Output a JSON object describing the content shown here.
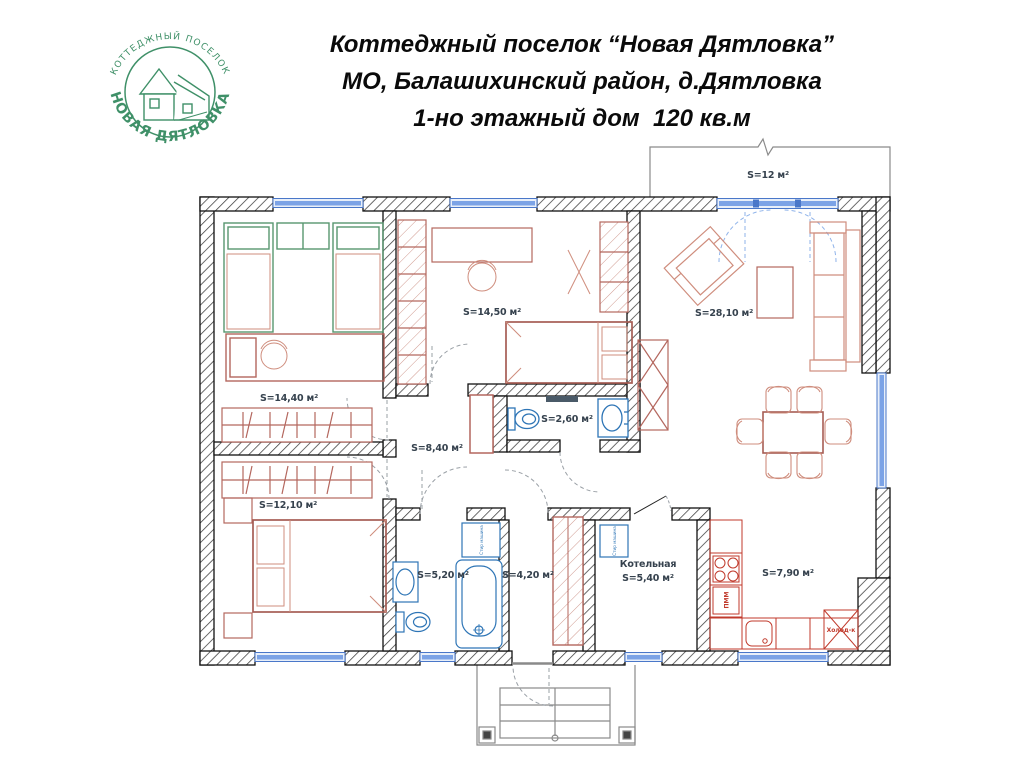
{
  "header": {
    "logo_arc_top": "КОТТЕДЖНЫЙ ПОСЕЛОК",
    "logo_arc_bottom": "НОВАЯ ДЯТЛОВКА",
    "title_lines": [
      "Коттеджный поселок “Новая Дятловка”",
      "МО, Балашихинский район, д.Дятловка",
      "1-но этажный дом  120 кв.м"
    ]
  },
  "plan": {
    "rooms": [
      {
        "name": "children-bedroom",
        "area_label": "S=14,40 м²"
      },
      {
        "name": "bedroom-2",
        "area_label": "S=12,10 м²"
      },
      {
        "name": "bedroom-3",
        "area_label": "S=14,50 м²"
      },
      {
        "name": "wc",
        "area_label": "S=2,60 м²"
      },
      {
        "name": "hallway",
        "area_label": "S=8,40 м²"
      },
      {
        "name": "living-room",
        "area_label": "S=28,10 м²"
      },
      {
        "name": "terrace",
        "area_label": "S=12 м²"
      },
      {
        "name": "bathroom",
        "area_label": "S=5,20 м²"
      },
      {
        "name": "entry-hall",
        "area_label": "S=4,20 м²"
      },
      {
        "name": "boiler-room",
        "room_name": "Котельная",
        "area_label": "S=5,40 м²"
      },
      {
        "name": "kitchen",
        "area_label": "S=7,90 м²"
      }
    ],
    "appliances": {
      "fridge": "Холод-к",
      "dishwasher": "ПММ",
      "washer": "Стир машина"
    },
    "colors": {
      "logo_green": "#3f9068",
      "furniture_red": "#b4675e",
      "furniture_red_light": "#cf8d7d",
      "furniture_green": "#57966f",
      "kitchen_red": "#c0392b",
      "window_blue": "#4a77c9",
      "window_fill": "#7ca3e6",
      "sanitary_blue": "#2e75b6",
      "wall": "#111111"
    }
  }
}
